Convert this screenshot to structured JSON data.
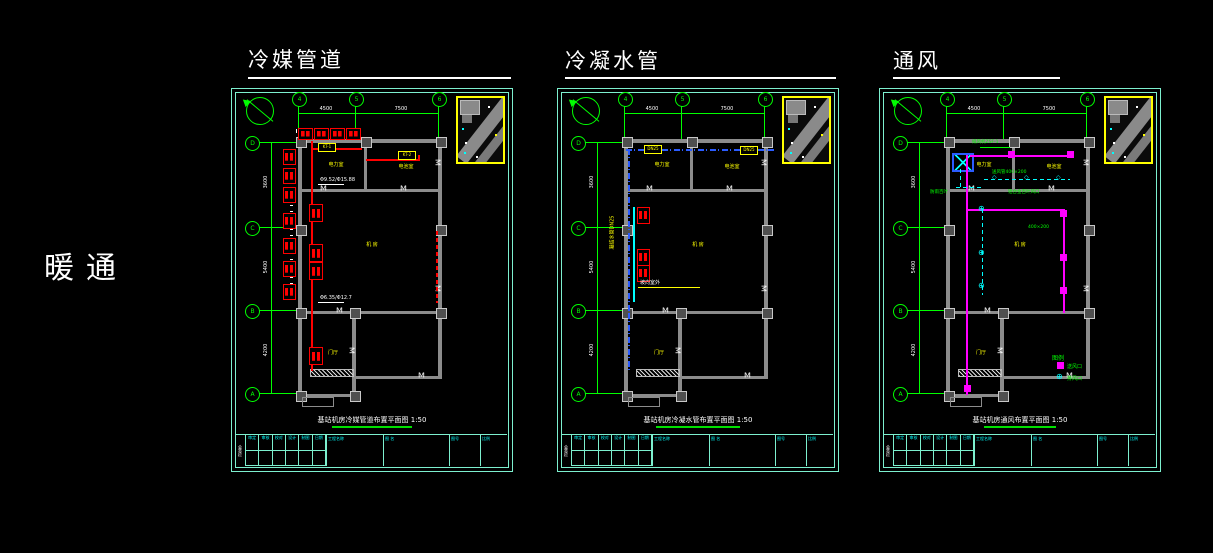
{
  "side_label": "暖通",
  "colors": {
    "background": "#000000",
    "sheet_border": "#7df0cf",
    "grid": "#00ff00",
    "wall": "#8c8c8c",
    "refrigerant": "#ff0000",
    "condensate": "#2b5cff",
    "duct": "#ff00ff",
    "labels": "#ffff00",
    "annotation": "#00ffff",
    "text": "#ffffff"
  },
  "titleblock": {
    "sign": "会签栏",
    "fields": [
      "审定",
      "审核",
      "校对",
      "设计",
      "制图",
      "日期"
    ],
    "project": "工程名称",
    "drawing": "图 名",
    "no": "图号",
    "scale": "比例"
  },
  "sheets": [
    {
      "title": "冷媒管道",
      "caption": "基站机房冷媒管道布置平面图 1:50",
      "grid": {
        "top": [
          "4",
          "5",
          "6"
        ],
        "left": [
          "D",
          "C",
          "B",
          "A"
        ]
      },
      "dims": {
        "top": [
          "4500",
          "7500"
        ],
        "left": [
          "3600",
          "5400",
          "4200"
        ]
      },
      "rooms": {
        "tl": "电力室",
        "tr": "电池室",
        "main": "机 房",
        "annex": "门厅"
      },
      "labels": {
        "p1": "Φ9.52/Φ15.88",
        "p2": "Φ6.35/Φ12.7",
        "t1": "KT-1",
        "t2": "KT-2"
      }
    },
    {
      "title": "冷凝水管",
      "caption": "基站机房冷凝水管布置平面图 1:50",
      "grid": {
        "top": [
          "4",
          "5",
          "6"
        ],
        "left": [
          "D",
          "C",
          "B",
          "A"
        ]
      },
      "dims": {
        "top": [
          "4500",
          "7500"
        ],
        "left": [
          "3600",
          "5400",
          "4200"
        ]
      },
      "rooms": {
        "tl": "电力室",
        "tr": "电池室",
        "main": "机 房",
        "annex": "门厅"
      },
      "labels": {
        "p1": "DN25",
        "p2": "凝结水管DN25",
        "p3": "坡向室外",
        "t1": "DN25",
        "t2": "DN25"
      }
    },
    {
      "title": "通风",
      "caption": "基站机房通风布置平面图 1:50",
      "grid": {
        "top": [
          "4",
          "5",
          "6"
        ],
        "left": [
          "D",
          "C",
          "B",
          "A"
        ]
      },
      "dims": {
        "top": [
          "4500",
          "7500"
        ],
        "left": [
          "3600",
          "5400",
          "4200"
        ]
      },
      "rooms": {
        "tl": "电力室",
        "tr": "电池室",
        "main": "机 房",
        "annex": "门厅"
      },
      "labels": {
        "p1": "排风机ZSF-1",
        "p2": "送风管400×200",
        "p3": "防雨百叶",
        "p4": "铝合金百叶风口",
        "p5": "400×200"
      },
      "legend": {
        "title": "图例",
        "supply": "送风口",
        "exhaust": "排风口"
      }
    }
  ]
}
